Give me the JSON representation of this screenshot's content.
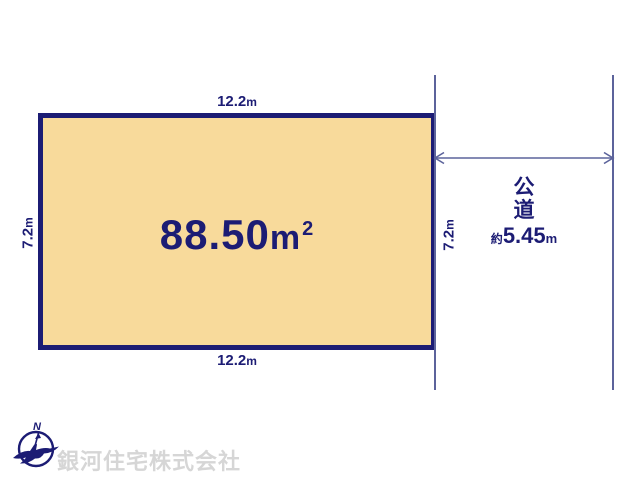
{
  "colors": {
    "navy": "#1c1c74",
    "parcel_fill": "#f8da9b",
    "dimension_line": "#5c639b",
    "watermark": "#d6d6d6"
  },
  "parcel": {
    "area_value": "88.50",
    "area_unit": "m",
    "area_sup": "2",
    "width_top": {
      "value": "12.2",
      "unit": "m"
    },
    "width_bottom": {
      "value": "12.2",
      "unit": "m"
    },
    "height_left": {
      "value": "7.2",
      "unit": "m"
    },
    "height_right": {
      "value": "7.2",
      "unit": "m"
    }
  },
  "road": {
    "name_char1": "公",
    "name_char2": "道",
    "width_prefix": "約",
    "width_value": "5.45",
    "width_unit": "m"
  },
  "compass": {
    "letter": "N"
  },
  "footer": {
    "company": "銀河住宅株式会社"
  }
}
